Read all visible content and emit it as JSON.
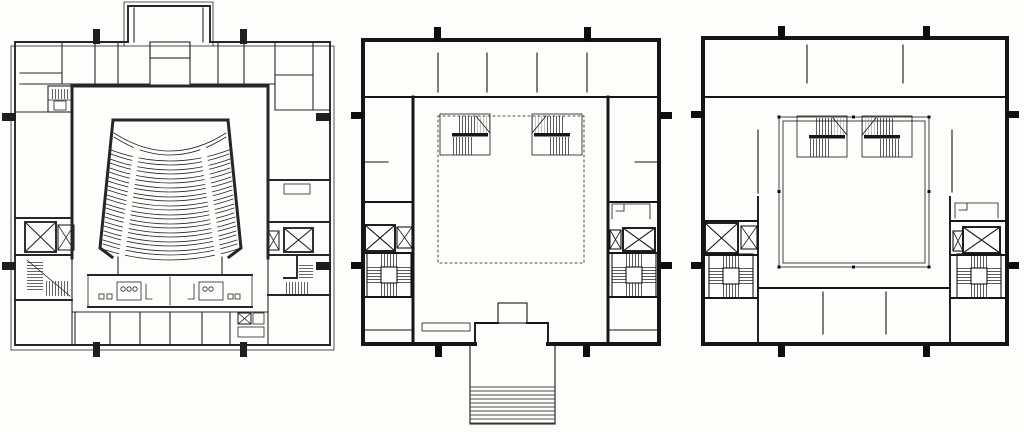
{
  "sheet": {
    "kind": "scanned architectural drawing",
    "description": "Three ink floor plans of a theatre building shown side by side on white paper; no text labels are visible",
    "ink_color": "#161616",
    "paper_color": "#fdfdfb"
  },
  "plans": [
    {
      "id": "auditorium-level",
      "position": "left",
      "label": "Auditorium level plan with fan-shaped seating",
      "elements": {
        "seating_row_bands": 12,
        "apron_curve": 1,
        "radial_aisles": 2,
        "elevator_shafts": 2,
        "service_shaft": 1,
        "stair_runs": 3,
        "wc_fixture_groups": 2,
        "column_markers": 8,
        "fly_tower_projection": true
      }
    },
    {
      "id": "foyer-level",
      "position": "center",
      "label": "Entrance and foyer level plan with exterior steps",
      "elements": {
        "void_outline": "dashed rectangle",
        "return_stairs": 2,
        "scissor_stairs": 2,
        "elevator_shafts": 2,
        "entrance_step_treads": 10,
        "column_markers": 8
      }
    },
    {
      "id": "balcony-level",
      "position": "right",
      "label": "Balcony level plan with gallery void",
      "elements": {
        "void_outline": "double line rectangle",
        "return_stairs": 2,
        "scissor_stairs": 2,
        "elevator_shafts": 2,
        "rear_room_partitions": 2,
        "column_markers": 8
      }
    }
  ],
  "symbols": {
    "elevator": "box crossed with X diagonals",
    "stair": "hatched tread lines",
    "column": "solid black tick on wall",
    "void": "dashed or double thin line"
  }
}
